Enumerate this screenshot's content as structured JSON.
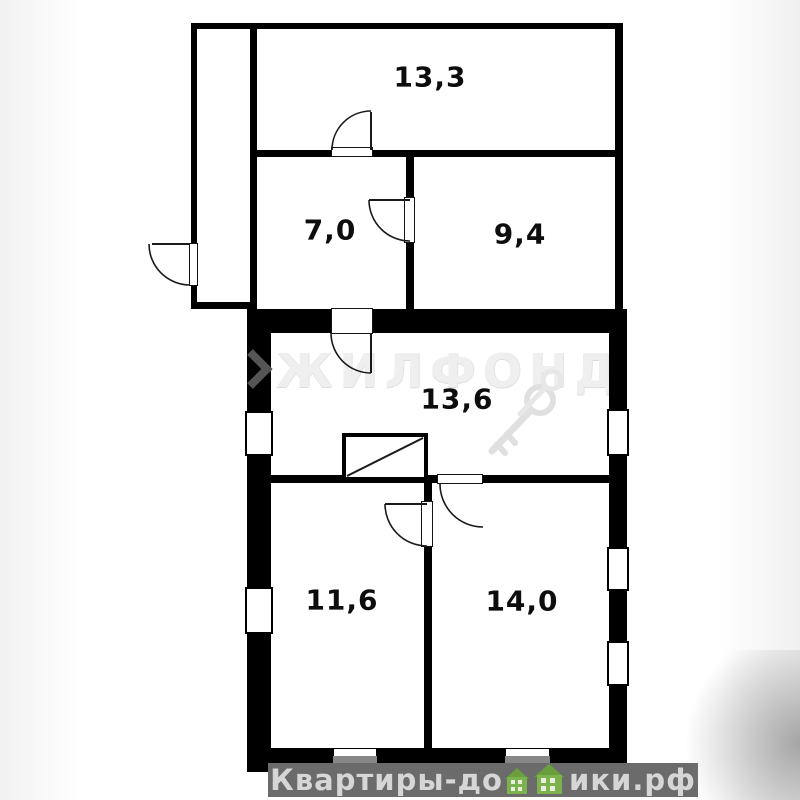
{
  "plan": {
    "type": "floor-plan",
    "rooms": [
      {
        "id": "room-13-3",
        "area_label": "13,3",
        "area_m2": 13.3
      },
      {
        "id": "room-7-0",
        "area_label": "7,0",
        "area_m2": 7.0
      },
      {
        "id": "room-9-4",
        "area_label": "9,4",
        "area_m2": 9.4
      },
      {
        "id": "room-13-6",
        "area_label": "13,6",
        "area_m2": 13.6
      },
      {
        "id": "room-11-6",
        "area_label": "11,6",
        "area_m2": 11.6
      },
      {
        "id": "room-14-0",
        "area_label": "14,0",
        "area_m2": 14.0
      }
    ],
    "door_count": 6,
    "window_count": 7
  },
  "watermarks": {
    "agency_name": "ЖИЛФОНД",
    "footer_full": "Квартиры-домики.рф",
    "footer_left": "Квартиры-до",
    "footer_right": "ики.рф"
  },
  "colors": {
    "wall": "#000000",
    "floor": "#ffffff",
    "footer_bar": "#6b6b6b",
    "footer_text": "#d6d6d6",
    "house_green": "#7cb24e",
    "house_roof_green": "#69a03c",
    "agency_watermark": "#efefef",
    "chevron_gray": "#555555"
  }
}
